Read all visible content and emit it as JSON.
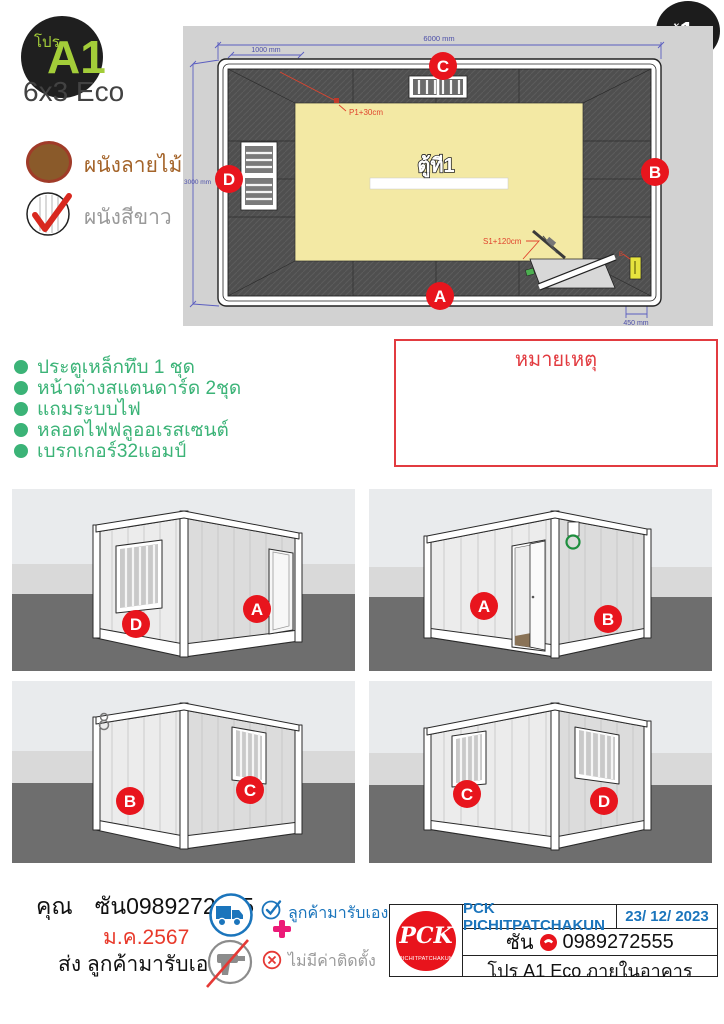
{
  "header": {
    "pro_label": "โปร",
    "model_code": "A1",
    "model_size": "6x3 Eco",
    "unit_prefix": "ตู้",
    "unit_number": "1",
    "unit_total": "/4"
  },
  "legend": {
    "wood_wall": "ผนังลายไม้",
    "white_wall": "ผนังสีขาว"
  },
  "plan": {
    "room_label": "ตู้ที1",
    "dim_length": "6000 mm",
    "dim_offset": "1000 mm",
    "dim_width": "3000 mm",
    "dim_door": "450 mm",
    "marker_p1": "P1+30cm",
    "marker_s1": "S1+120cm",
    "marker_breaker": "B",
    "side_top": "C",
    "side_right": "B",
    "side_bottom": "A",
    "side_left": "D"
  },
  "features": [
    "ประตูเหล็กทึบ 1 ชุด",
    "หน้าต่างสแตนดาร์ด 2ชุด",
    "แถมระบบไฟ",
    "หลอดไฟฟลูออเรสเซนต์",
    "เบรกเกอร์32แอมป์"
  ],
  "note_title": "หมายเหตุ",
  "views": [
    {
      "label_left": "D",
      "label_right": "A"
    },
    {
      "label_left": "A",
      "label_right": "B"
    },
    {
      "label_left": "B",
      "label_right": "C"
    },
    {
      "label_left": "C",
      "label_right": "D"
    }
  ],
  "footer": {
    "customer_prefix": "คุณ",
    "customer_value": "ซัน0989272555",
    "date": "ม.ค.2567",
    "shipping": "ส่ง ลูกค้ามารับเอง",
    "pickup": "ลูกค้ามารับเอง",
    "no_install": "ไม่มีค่าติดตั้ง"
  },
  "company": {
    "name": "PCK PICHITPATCHAKUN",
    "doc_date": "23/ 12/ 2023",
    "contact_name": "ซัน",
    "phone": "0989272555",
    "model_line": "โปร A1 Eco ภายในอาคาร",
    "logo_monogram": "PCK",
    "logo_text": "PICHITPATCHAKUN"
  },
  "colors": {
    "accent_red": "#e8151d",
    "lime_green": "#a3cd39",
    "feature_green": "#3bb377",
    "brand_blue": "#1b75bc",
    "dim_blue": "#5b5ec0",
    "marker_red": "#e0442e",
    "floor_yellow": "#f3e9a4",
    "note_red": "#e23b40"
  }
}
